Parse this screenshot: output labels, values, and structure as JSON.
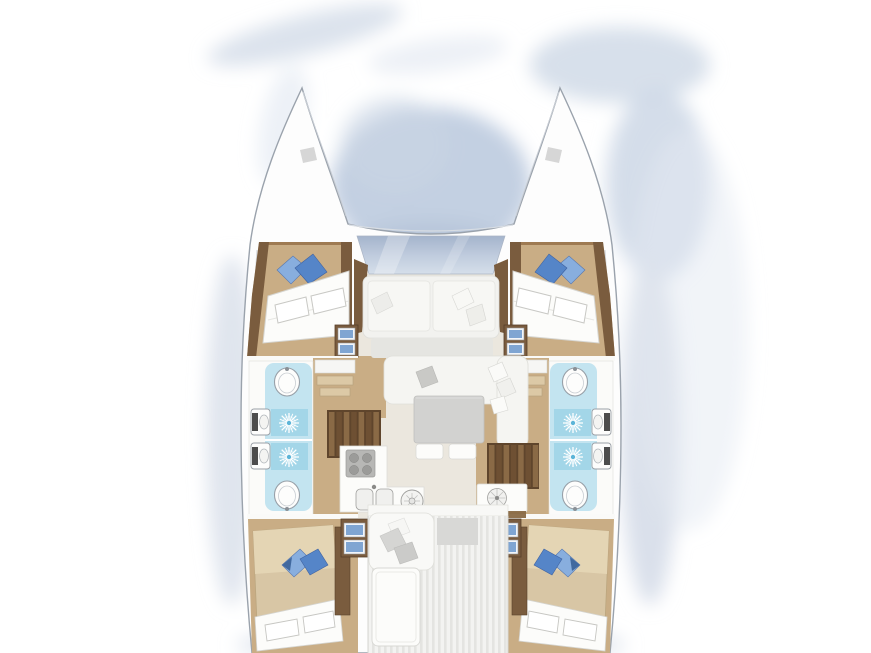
{
  "figure": {
    "title": "Catamaran interior layout - overhead floor plan, 4 cabins and 4 heads",
    "type": "boat-floor-plan",
    "view": "top-down",
    "symmetry": "mirrored about vessel centerline"
  },
  "palette": {
    "background": "#ffffff",
    "wash": "#cdd8e6",
    "washDeep": "#b8c6da",
    "hull": "#fdfdfd",
    "hullStroke": "#9aa2ac",
    "wood": "#7a5c3e",
    "woodMid": "#99744c",
    "floorTan": "#c9ad85",
    "floorTanLight": "#dcc9a6",
    "window": "#b4c1d6",
    "bath": "#c3e4f0",
    "bathDeep": "#9ed3e6",
    "mattress": "#fcfcfa",
    "mattressTan": "#d8c6a5",
    "pillowBlue": "#5585c8",
    "pillowBlueLight": "#88aede",
    "sofa": "#f2f2ef",
    "sofaShade": "#e5e5e1",
    "table": "#d2d2d0",
    "stairDark": "#5f452c",
    "stairMid": "#6e5033",
    "stairLight": "#8a6a46",
    "stripe": "#e4e4e1"
  },
  "rooms": [
    {
      "id": "foredeck",
      "label": "Foredeck seating and coachroof window",
      "features": [
        "two seat cushions",
        "scatter pillows",
        "glazed coachroof panel"
      ]
    },
    {
      "id": "salon-galley",
      "label": "Salon, galley and companionway stairs",
      "features": [
        "U-sofa",
        "gray table",
        "two seat cushions",
        "stove with 4 burners",
        "double sink",
        "round basin",
        "extractor fan",
        "port stairs",
        "starboard stairs"
      ]
    },
    {
      "id": "aft-cockpit",
      "label": "Aft cockpit",
      "features": [
        "bench with pillows",
        "cockpit table",
        "striped teak sole"
      ]
    },
    {
      "id": "cabin-forward-port",
      "label": "Forward cabin, port hull",
      "features": [
        "double berth",
        "two blue pillows",
        "two-drawer unit"
      ]
    },
    {
      "id": "head-port",
      "label": "Port hull bathrooms",
      "features": [
        "2 oval sinks",
        "2 shower drains",
        "2 toilets"
      ]
    },
    {
      "id": "cabin-aft-port",
      "label": "Aft cabin, port hull",
      "features": [
        "double berth",
        "two blue pillows",
        "wardrobe",
        "two-drawer unit"
      ]
    },
    {
      "id": "hull-starboard",
      "label": "Starboard hull (mirror of port): forward cabin, bathrooms, aft cabin",
      "features": [
        "double berths",
        "blue pillows",
        "2 sinks",
        "2 showers",
        "2 toilets",
        "drawer units"
      ]
    }
  ],
  "deck": {
    "bow_hatches": 2,
    "hulls": 2
  }
}
